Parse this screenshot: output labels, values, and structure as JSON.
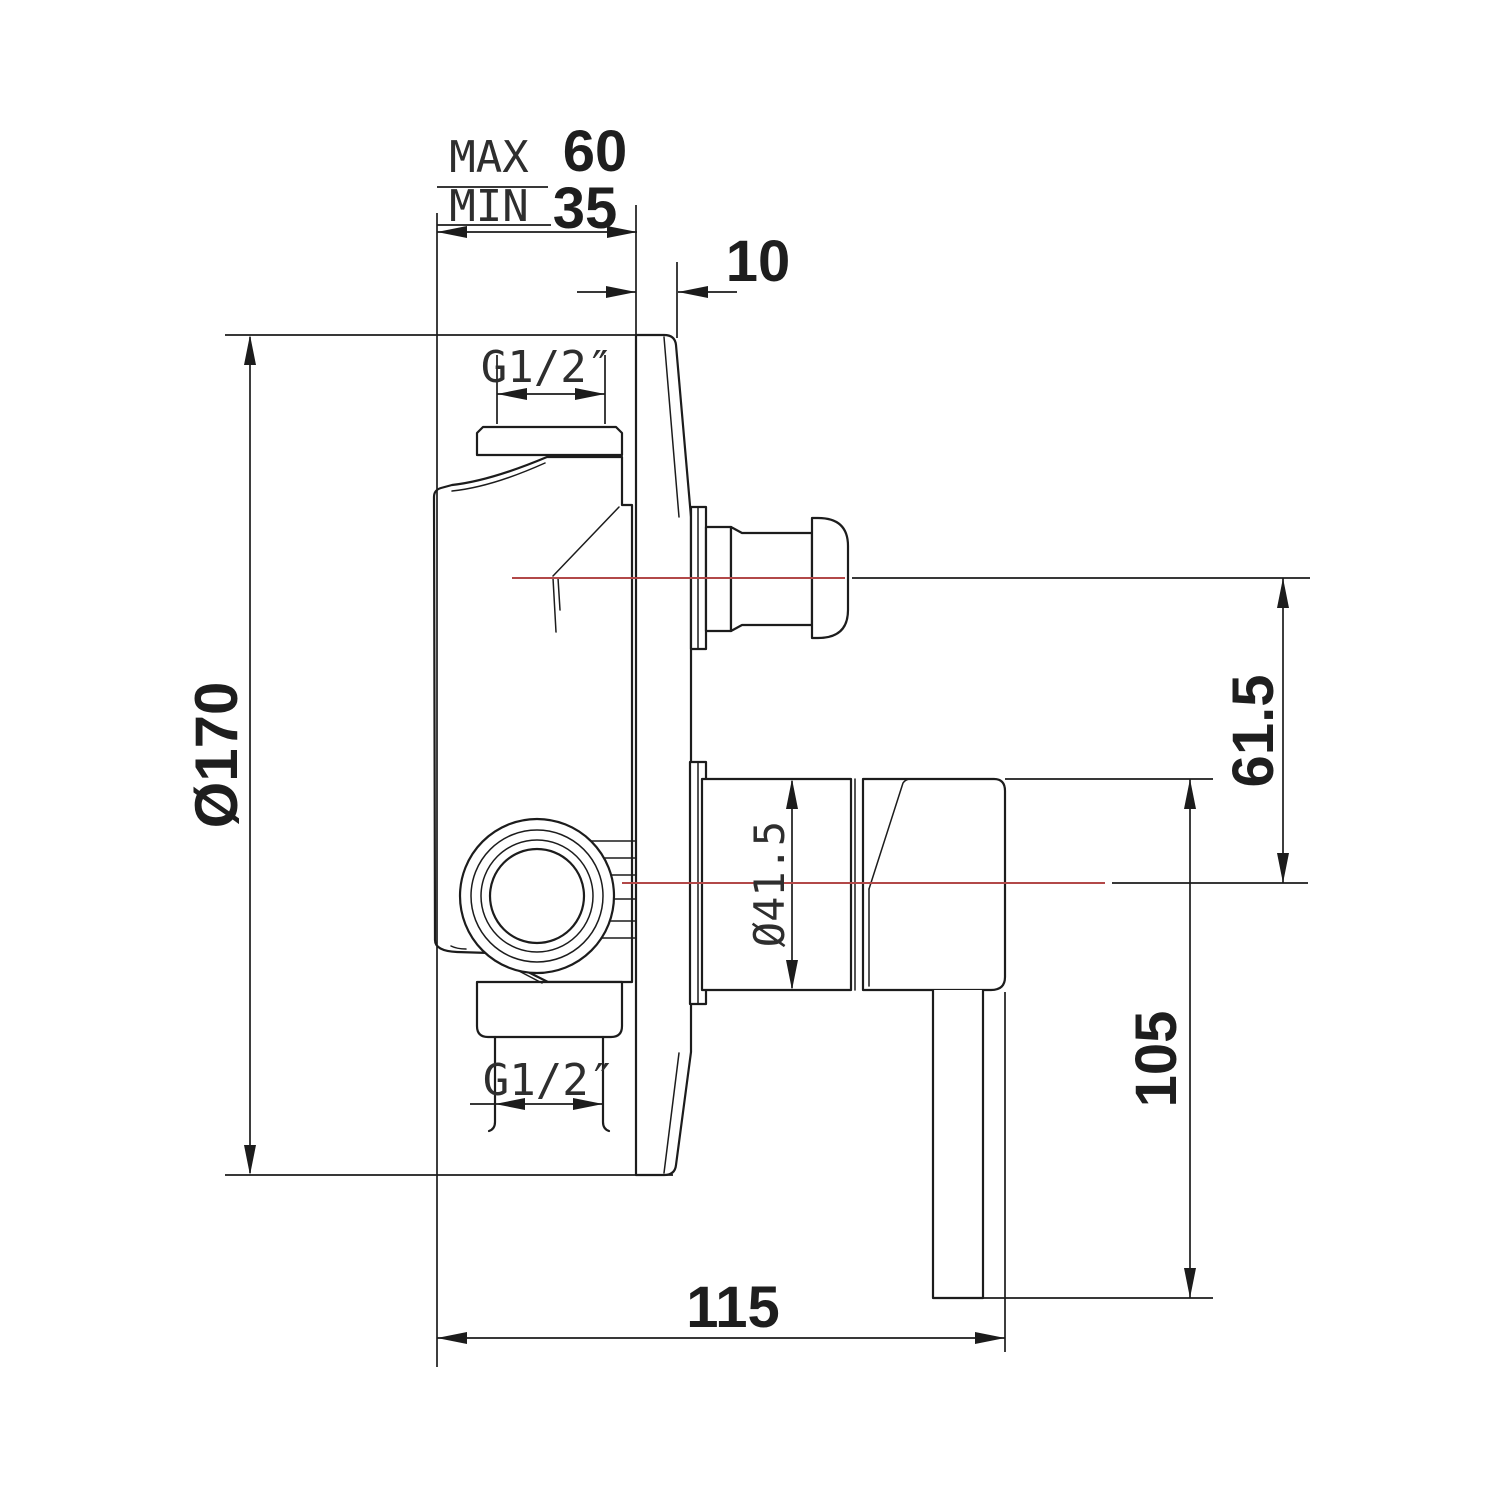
{
  "drawing": {
    "background": "#ffffff",
    "line_color": "#1c1c1c",
    "centerline_color": "#b24848",
    "dimensions": {
      "max_label": "MAX",
      "max_value": "60",
      "min_label": "MIN",
      "min_value": "35",
      "plate_edge_offset": "10",
      "plate_diameter": "Ø170",
      "top_port_thread": "G1/2″",
      "bottom_port_thread": "G1/2″",
      "axis_spacing": "61.5",
      "handle_base_diameter": "Ø41.5",
      "handle_drop": "105",
      "body_depth": "115"
    }
  }
}
